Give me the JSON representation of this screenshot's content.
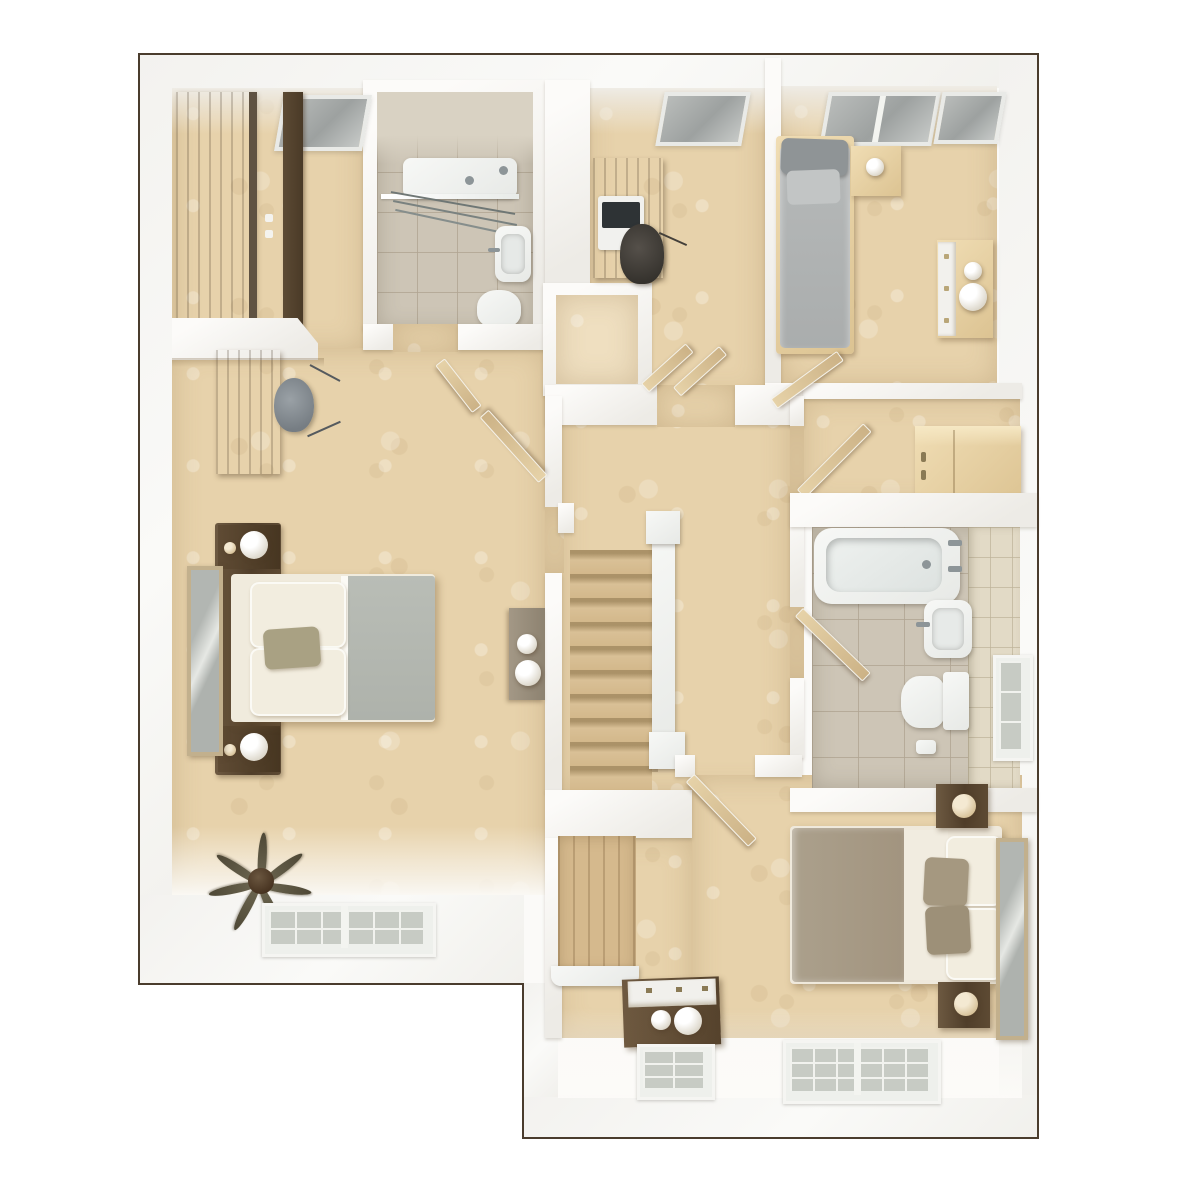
{
  "scene": {
    "kind": "3d-floor-plan-rendering",
    "view": "top-down-dollhouse",
    "floor": "upper-floor",
    "visible_text": ""
  },
  "palette": {
    "outline": "#4a3c2d",
    "background": "#ffffff",
    "wall_lit": "#fbfaf8",
    "wall_shade": "#ecebe6",
    "carpet": "#e7d2ab",
    "carpet_light": "#efdfc0",
    "stair_wood": "#d9c096",
    "plank_wood": "#d5b98d",
    "tile_floor": "#cdc5b6",
    "tile_wall": "#e2dac6",
    "wood_dark": "#57432d",
    "wood_grey": "#8b7e6e",
    "wood_light": "#e8d4a8",
    "fixture_white": "#f2f3f1",
    "glass_grey": "#c7cbc4",
    "bed_grey": "#b2b5b5",
    "bed_taupe": "#a79a86",
    "mirror_frame": "#c2b08d",
    "chair_grey": "#8b9196",
    "plant_green": "#5e5742"
  },
  "rooms": [
    {
      "id": "master-bedroom",
      "features": [
        "double-bed",
        "dark-headboard",
        "bedside-table-lamp-left",
        "bedside-table-lamp-right",
        "tall-wardrobe",
        "wardrobe-divider-panel",
        "desk",
        "office-chair",
        "leaning-mirror",
        "side-chest-with-lamps",
        "potted-plant",
        "glazed-window",
        "roof-window"
      ]
    },
    {
      "id": "en-suite-shower-room",
      "features": [
        "shower-enclosure",
        "glass-screen",
        "wash-basin",
        "toilet",
        "tiled-floor",
        "door-to-bedroom"
      ]
    },
    {
      "id": "study-bedroom",
      "features": [
        "desk",
        "laptop",
        "office-chair",
        "roof-window",
        "airing-cupboard-double-doors"
      ]
    },
    {
      "id": "bedroom-top-right",
      "features": [
        "single-bed-grey",
        "bedside-table-lamp",
        "dresser-with-bowls",
        "roof-window-large",
        "roof-window-small",
        "entry-door"
      ]
    },
    {
      "id": "store-room",
      "features": [
        "built-in-cupboard",
        "entry-door"
      ]
    },
    {
      "id": "family-bathroom",
      "features": [
        "bathtub",
        "wash-basin",
        "toilet",
        "toilet-roll",
        "tiled-floor",
        "tiled-wall",
        "glazed-window",
        "entry-door"
      ]
    },
    {
      "id": "landing",
      "features": [
        "staircase-down",
        "handrail",
        "newel-post-top",
        "newel-post-bottom",
        "cased-opening"
      ]
    },
    {
      "id": "bedroom-bottom",
      "features": [
        "double-bed",
        "bedside-table-lamp-top",
        "bedside-table-lamp-bottom",
        "leaning-mirror",
        "dresser-with-lamps",
        "window-large",
        "window-small",
        "entry-door",
        "stair-bulkhead"
      ]
    }
  ]
}
